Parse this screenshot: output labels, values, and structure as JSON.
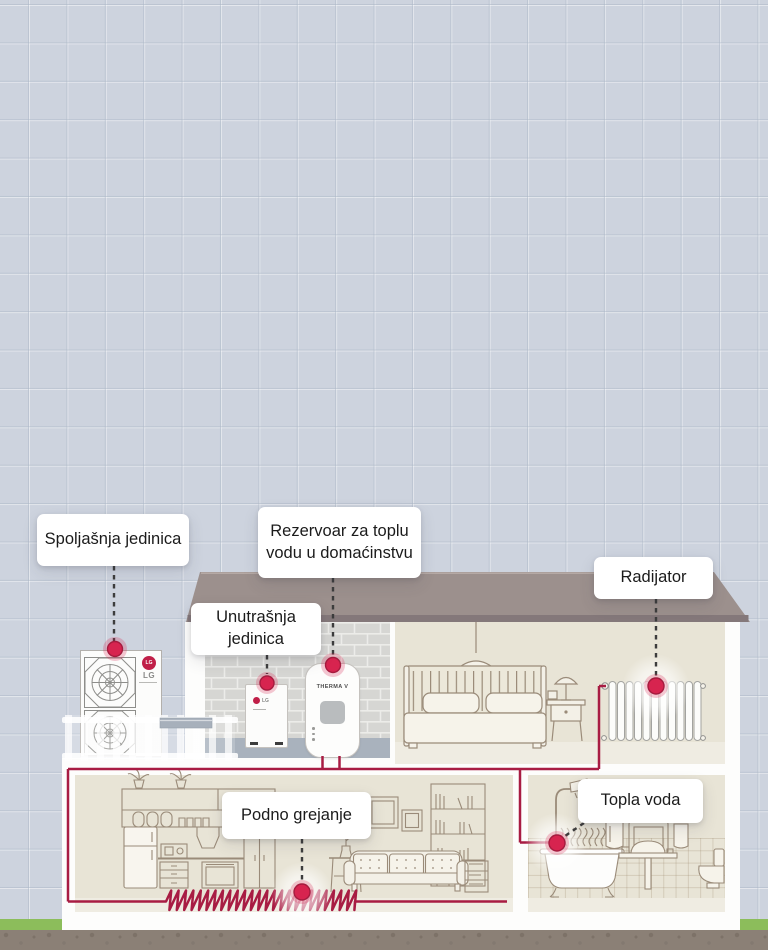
{
  "scene": {
    "labels": {
      "outdoor": "Spoljašnja jedinica",
      "tank": "Rezervoar za toplu vodu u domaćinstvu",
      "indoor": "Unutrašnja jedinica",
      "radiator": "Radijator",
      "floor_heating": "Podno grejanje",
      "hot_water": "Topla voda"
    },
    "equipment": {
      "outdoor_unit_brand": "LG",
      "outdoor_unit_badge": "LG",
      "indoor_unit_brand": "LG",
      "tank_model": "THERMA V"
    },
    "colors": {
      "background": "#cdd3de",
      "grid_line": "#adb8c7",
      "roof": "#9c908d",
      "roof_edge": "#84787a",
      "wall_white": "#fdfdfc",
      "room_beige": "#e8e4d6",
      "room_floor": "#efece2",
      "brick": "#d6d6d3",
      "brick_mortar": "#ecece9",
      "utility_floor": "#a9b2bd",
      "pipe_red": "#a81c43",
      "hotspot_red": "#d7244f",
      "connector_dark": "#3d3d3d",
      "furniture_line": "#9a8b79",
      "supply_pipe_gray": "#a7b0bb",
      "ground": "#8b8076",
      "grass": "#8cbd5b",
      "lg_red": "#c01f48"
    }
  }
}
